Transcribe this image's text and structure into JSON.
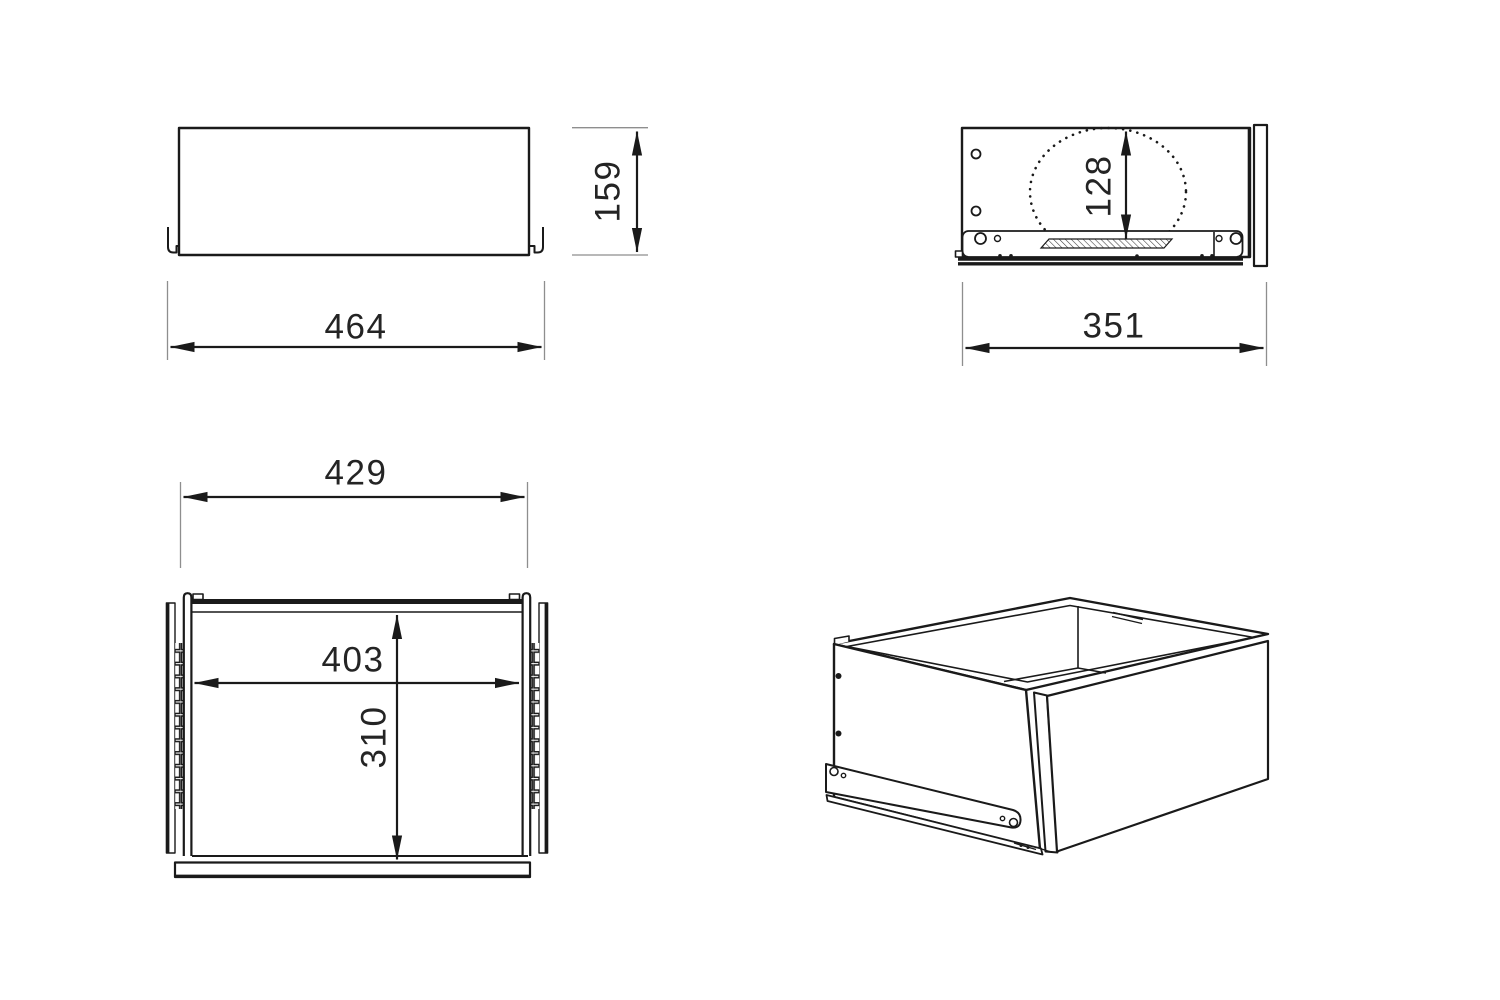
{
  "diagram": {
    "type": "technical-drawing",
    "subject": "drawer with slide rails",
    "colors": {
      "line": "#1a1a1a",
      "extension_line": "#8e8e8e",
      "text": "#242424",
      "background": "#ffffff"
    },
    "views": {
      "front": {
        "label_width": "464",
        "label_height": "159",
        "value_width_mm": 464,
        "value_height_mm": 159
      },
      "side": {
        "label_width": "351",
        "label_inner_height": "128",
        "value_width_mm": 351,
        "value_inner_height_mm": 128
      },
      "top": {
        "label_outer_width": "429",
        "label_inner_width": "403",
        "label_inner_depth": "310",
        "value_outer_width_mm": 429,
        "value_inner_width_mm": 403,
        "value_inner_depth_mm": 310
      },
      "isometric": {
        "description": "3D view of drawer box with bottom slide rail"
      }
    }
  }
}
